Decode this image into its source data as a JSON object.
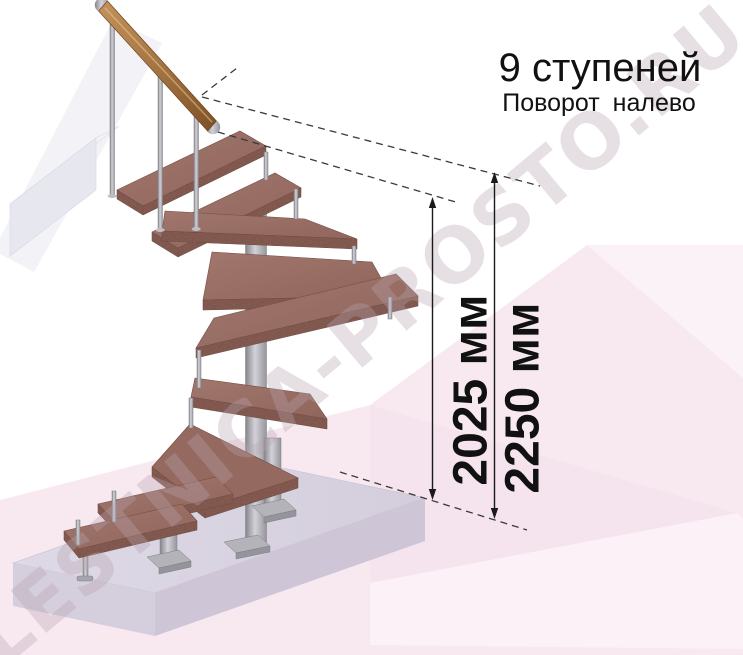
{
  "title": {
    "line1": "9 ступеней",
    "line2": "Поворот налево"
  },
  "annotations": {
    "dim_inner": "2025 мм",
    "dim_outer": "2250 мм"
  },
  "watermark": {
    "text": "LESTNICA-PROSTO.RU"
  },
  "illustration": {
    "description": "3D render of a modular staircase with 9 steps and a left turn: two straight bottom steps, five winder steps rotating around a central steel column, two straight top steps with a wooden handrail on steel balusters, standing on a floor slab",
    "colors": {
      "tread_wood": "#9b7068",
      "tread_edge": "#7a514a",
      "metal_light": "#cfcfd5",
      "metal_dark": "#86868c",
      "handrail_wood": "#a87a4b",
      "floor_slab": "#d9d3e1",
      "wall_beam": "#e9e9f1",
      "background_pink": "#f8e9f1",
      "annotation_black": "#1a1a1a"
    }
  }
}
